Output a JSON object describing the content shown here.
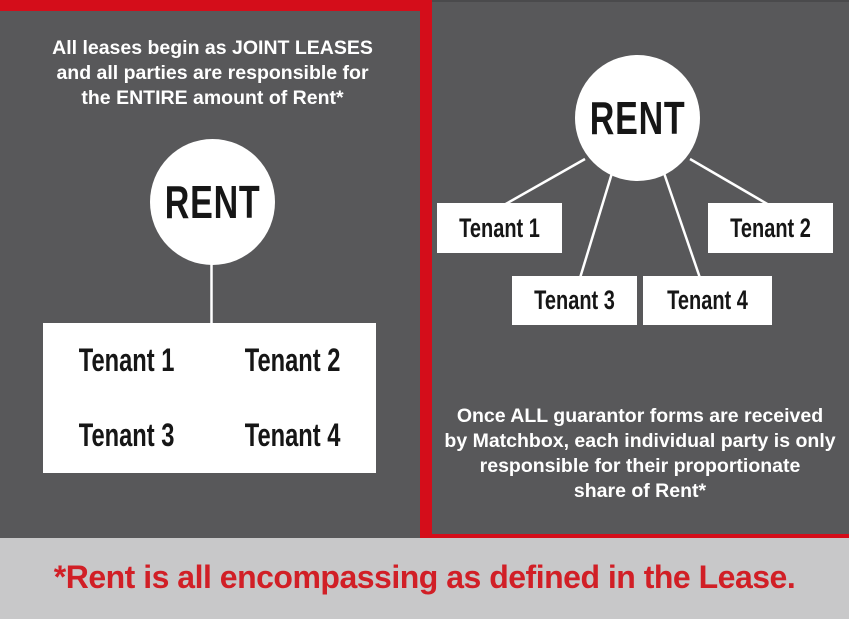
{
  "colors": {
    "background": "#58585a",
    "accent_red": "#d40d1a",
    "footer_bar": "#c8c8c9",
    "footer_text_red": "#d11f26",
    "node_fill": "#ffffff",
    "node_text": "#161616",
    "heading_text": "#ffffff"
  },
  "left_panel": {
    "heading_lines": [
      "All leases begin as JOINT LEASES",
      "and all parties are responsible for",
      "the ENTIRE amount of Rent*"
    ],
    "node_label": "RENT",
    "tenants": [
      "Tenant 1",
      "Tenant 2",
      "Tenant 3",
      "Tenant 4"
    ]
  },
  "right_panel": {
    "node_label": "RENT",
    "tenants": [
      "Tenant 1",
      "Tenant 2",
      "Tenant 3",
      "Tenant 4"
    ],
    "caption_lines": [
      "Once ALL guarantor forms are received",
      "by Matchbox, each individual party is only",
      "responsible for their proportionate",
      "share of Rent*"
    ]
  },
  "footer": {
    "note": "*Rent is all encompassing as defined in the Lease."
  }
}
